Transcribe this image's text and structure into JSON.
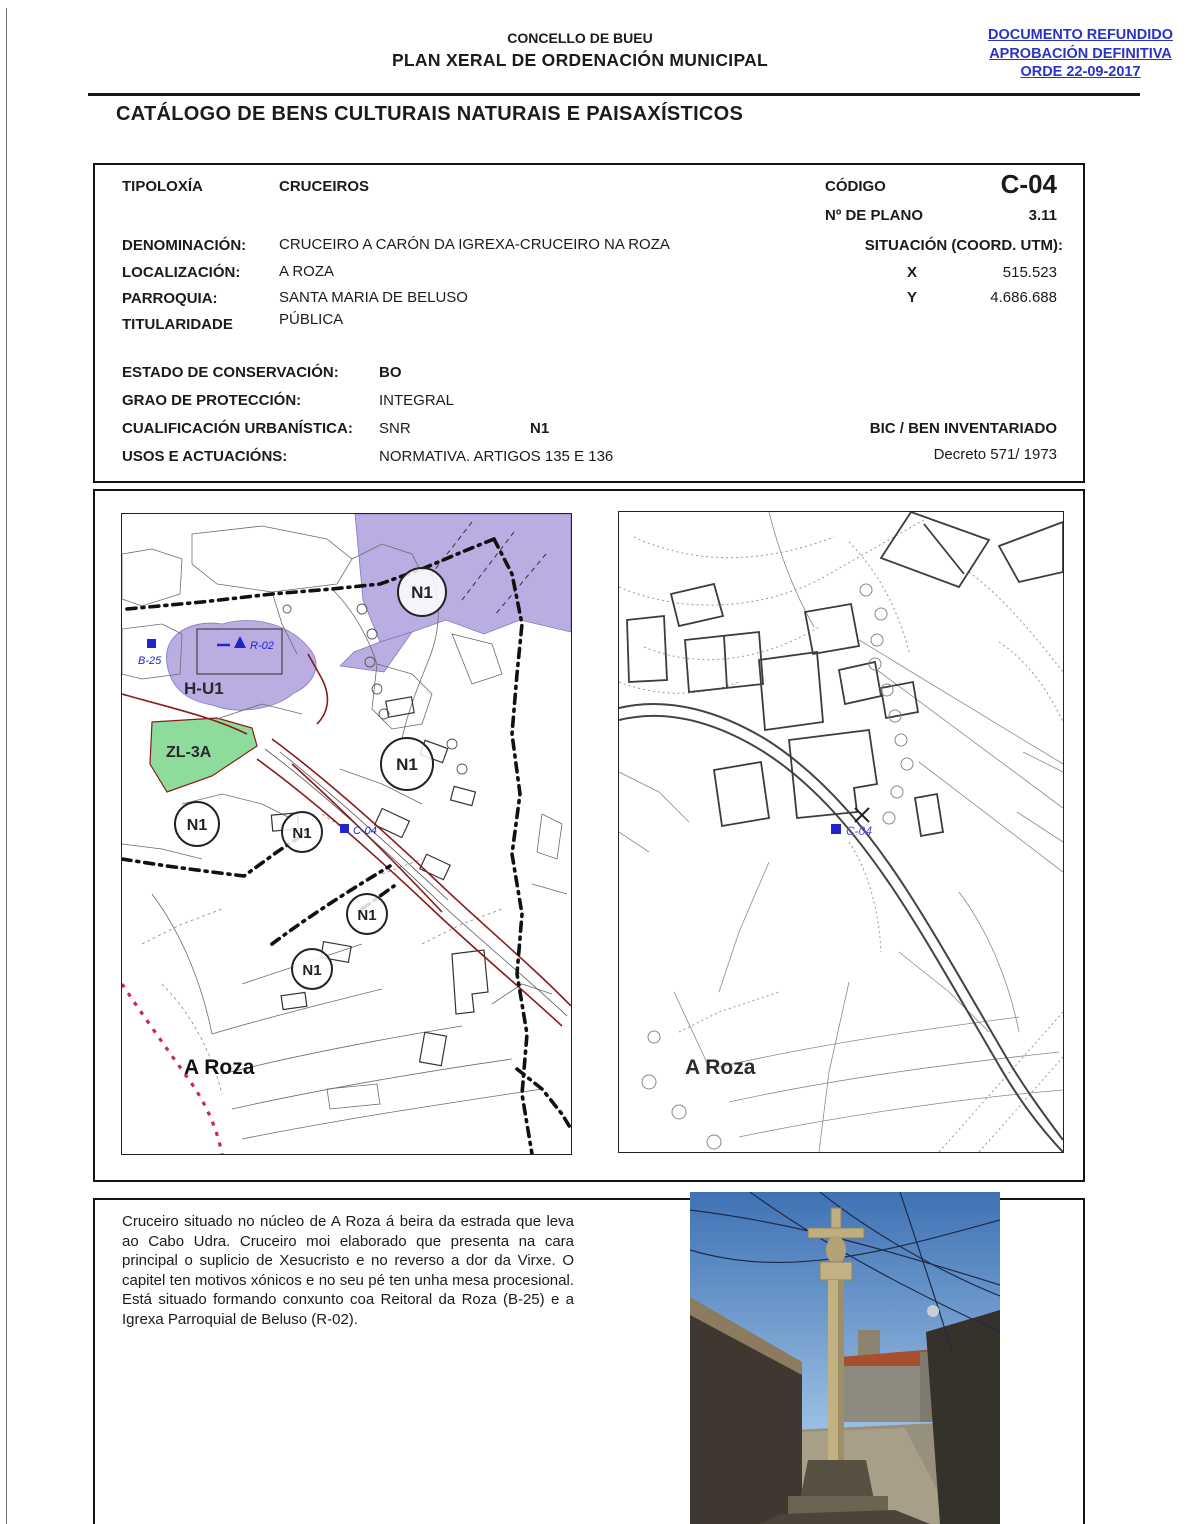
{
  "header": {
    "org": "CONCELLO DE BUEU",
    "plan": "PLAN XERAL DE ORDENACIÓN MUNICIPAL",
    "stamp": [
      "DOCUMENTO REFUNDIDO",
      "APROBACIÓN DEFINITIVA",
      "ORDE 22-09-2017"
    ],
    "stamp_color": "#2a33c8"
  },
  "title": "CATÁLOGO DE BENS CULTURAIS NATURAIS E PAISAXÍSTICOS",
  "record": {
    "tipoloxia_label": "TIPOLOXÍA",
    "tipoloxia_value": "CRUCEIROS",
    "codigo_label": "CÓDIGO",
    "codigo_value": "C-04",
    "plano_label": "Nº DE PLANO",
    "plano_value": "3.11",
    "denominacion_label": "DENOMINACIÓN:",
    "denominacion_value": "CRUCEIRO A CARÓN DA IGREXA-CRUCEIRO NA ROZA",
    "situacion_label": "SITUACIÓN (COORD. UTM):",
    "localizacion_label": "LOCALIZACIÓN:",
    "localizacion_value": "A ROZA",
    "x_label": "X",
    "x_value": "515.523",
    "parroquia_label": "PARROQUIA:",
    "parroquia_value": "SANTA MARIA DE BELUSO",
    "y_label": "Y",
    "y_value": "4.686.688",
    "titularidade_label": "TITULARIDADE",
    "titularidade_value": "PÚBLICA",
    "estado_label": "ESTADO DE CONSERVACIÓN:",
    "estado_value": "BO",
    "grao_label": "GRAO DE PROTECCIÓN:",
    "grao_value": "INTEGRAL",
    "cualificacion_label": "CUALIFICACIÓN URBANÍSTICA:",
    "cualificacion_value": "SNR",
    "cualificacion_value2": "N1",
    "bic_label": "BIC / BEN INVENTARIADO",
    "usos_label": "USOS E ACTUACIÓNS:",
    "usos_value": "NORMATIVA. ARTIGOS 135 E 136",
    "decreto_value": "Decreto 571/ 1973"
  },
  "maps": {
    "left": {
      "place_label": "A Roza",
      "n1": "N1",
      "zone_hu1": "H-U1",
      "zone_zl3a": "ZL-3A",
      "marker_b25": "B-25",
      "marker_r02": "R-02",
      "marker_c04": "C-04",
      "colors": {
        "residential_zone": "#b9ade2",
        "green_zone": "#8edc9b",
        "boundary_red": "#8b1a1a",
        "marker_blue": "#2323cc",
        "dotted_pink": "#cc2266"
      }
    },
    "right": {
      "place_label": "A Roza",
      "marker_c04": "C-04"
    }
  },
  "description": "Cruceiro situado no núcleo de A Roza á beira da estrada que leva ao Cabo Udra. Cruceiro moi elaborado que presenta na cara principal o suplicio de Xesucristo e no reverso a dor da Virxe. O capitel ten motivos xónicos e no seu pé ten unha mesa procesional. Está situado formando conxunto coa Reitoral da Roza (B-25) e a Igrexa Parroquial de Beluso (R-02)."
}
